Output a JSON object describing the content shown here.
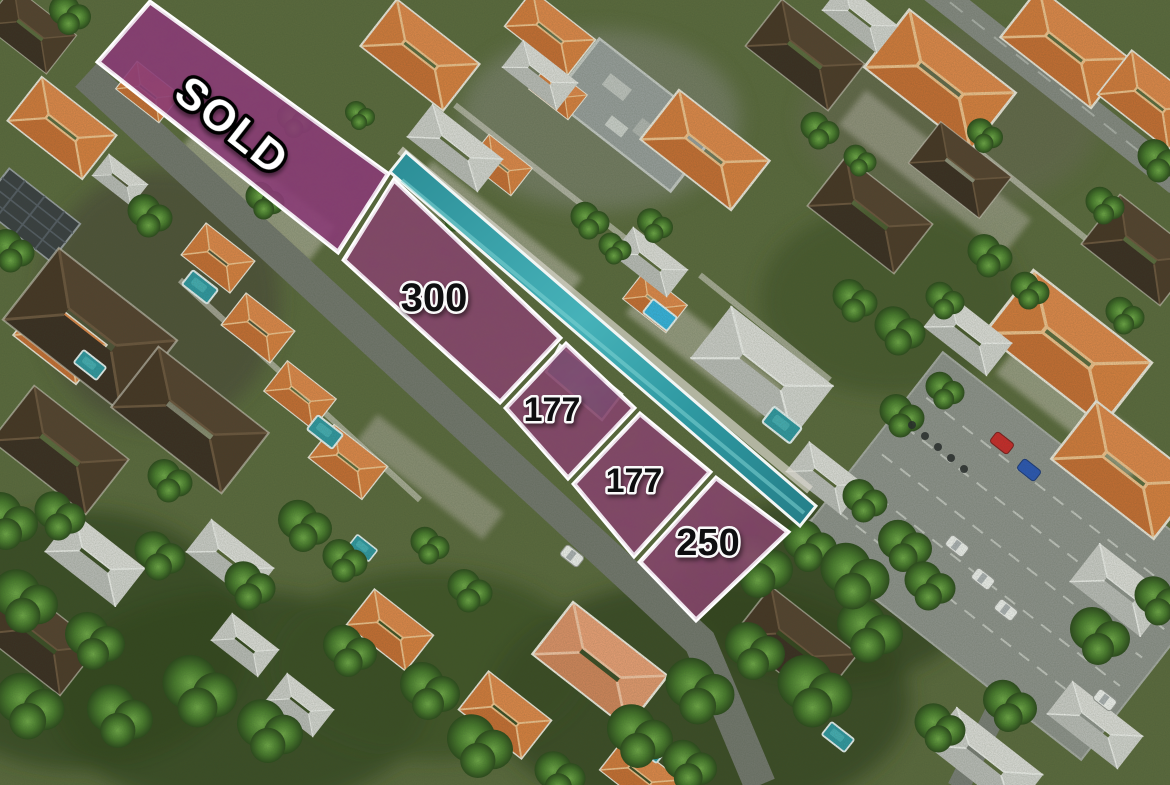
{
  "overlay": {
    "type": "land-plot-overlay",
    "border_color": "#ffffff",
    "plots": [
      {
        "id": "sold",
        "label": "SOLD",
        "sold": true,
        "fill": "#8b3c76"
      },
      {
        "id": "plot-300",
        "label": "300",
        "sold": false,
        "fill": "#85486a"
      },
      {
        "id": "plot-177-upper",
        "label": "177",
        "sold": false,
        "fill": "#85486a"
      },
      {
        "id": "plot-177-lower",
        "label": "177",
        "sold": false,
        "fill": "#85486a"
      },
      {
        "id": "plot-250",
        "label": "250",
        "sold": false,
        "fill": "#85486a"
      }
    ],
    "label_style": {
      "number_fill": "#0e0e10",
      "number_halo": "#fafafa",
      "sold_fill": "#ffffff",
      "sold_halo": "#000000"
    }
  },
  "scene": {
    "colors": {
      "pool": "#2f9aa4",
      "roof_orange": "#d9823f",
      "roof_dark": "#46362a",
      "foliage": "#4c6b33",
      "road": "#7b7f78"
    }
  }
}
